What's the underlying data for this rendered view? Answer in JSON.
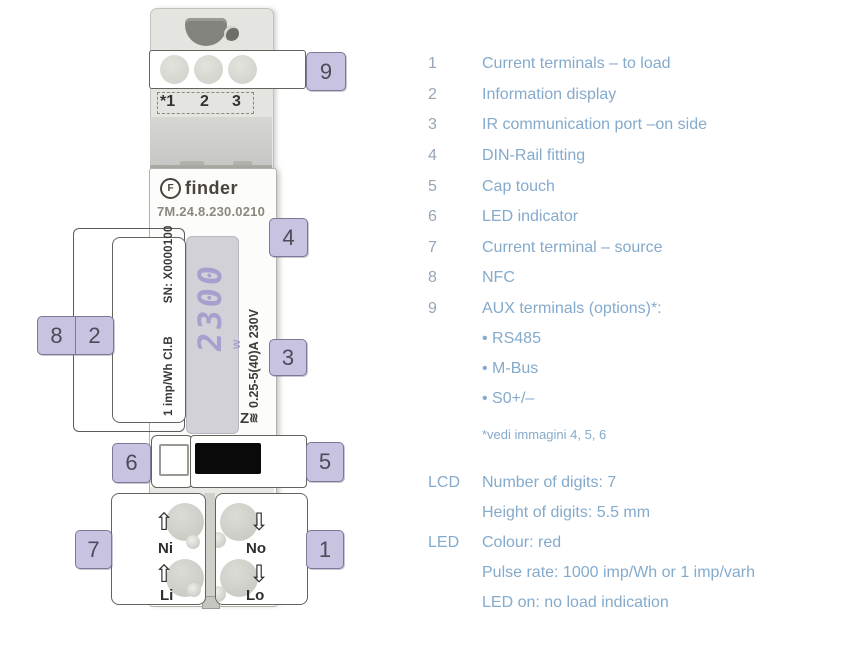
{
  "colors": {
    "legend_text": "#84aacc",
    "legend_number": "#97a5b6",
    "callout_fill": "#c7c3e1",
    "callout_border": "#7d7898",
    "lcd_digit_color": "#a79fcd",
    "led_pulse_color_name": "red"
  },
  "device": {
    "brand": "finder",
    "logo_glyph": "F",
    "model": "7M.24.8.230.0210",
    "serial": "SN: X0000100",
    "meter_class": "1 imp/Wh Cl.B",
    "rating": "0.25-5(40)A 230V",
    "lcd_value": "2300",
    "lcd_unit": "w",
    "ir_glyph": "Z",
    "ir_waves": "≋",
    "aux_terminal_numbers": {
      "t1": "*1",
      "t2": "2",
      "t3": "3"
    },
    "terminal_labels": {
      "ni": "Ni",
      "li": "Li",
      "no": "No",
      "lo": "Lo"
    },
    "arrow_up": "⇧",
    "arrow_down": "⇩"
  },
  "callout_numbers": {
    "c1": "1",
    "c2": "2",
    "c3": "3",
    "c4": "4",
    "c5": "5",
    "c6": "6",
    "c7": "7",
    "c8": "8",
    "c9": "9"
  },
  "legend": {
    "items": [
      {
        "num": "1",
        "label": "Current terminals – to load"
      },
      {
        "num": "2",
        "label": "Information display"
      },
      {
        "num": "3",
        "label": "IR communication port –on side"
      },
      {
        "num": "4",
        "label": "DIN-Rail fitting"
      },
      {
        "num": "5",
        "label": "Cap touch"
      },
      {
        "num": "6",
        "label": "LED indicator"
      },
      {
        "num": "7",
        "label": "Current terminal – source"
      },
      {
        "num": "8",
        "label": "NFC"
      },
      {
        "num": "9",
        "label": "AUX terminals (options)*:"
      }
    ],
    "options": [
      "• RS485",
      "• M-Bus",
      "• S0+/–"
    ],
    "footnote": "*vedi immagini 4, 5, 6",
    "specs": [
      {
        "label": "LCD",
        "text": "Number of digits: 7"
      },
      {
        "label": "",
        "text": "Height of digits: 5.5 mm"
      },
      {
        "label": "LED",
        "text": "Colour: red"
      },
      {
        "label": "",
        "text": "Pulse rate: 1000 imp/Wh or 1 imp/varh"
      },
      {
        "label": "",
        "text": "LED on: no load indication"
      }
    ]
  }
}
